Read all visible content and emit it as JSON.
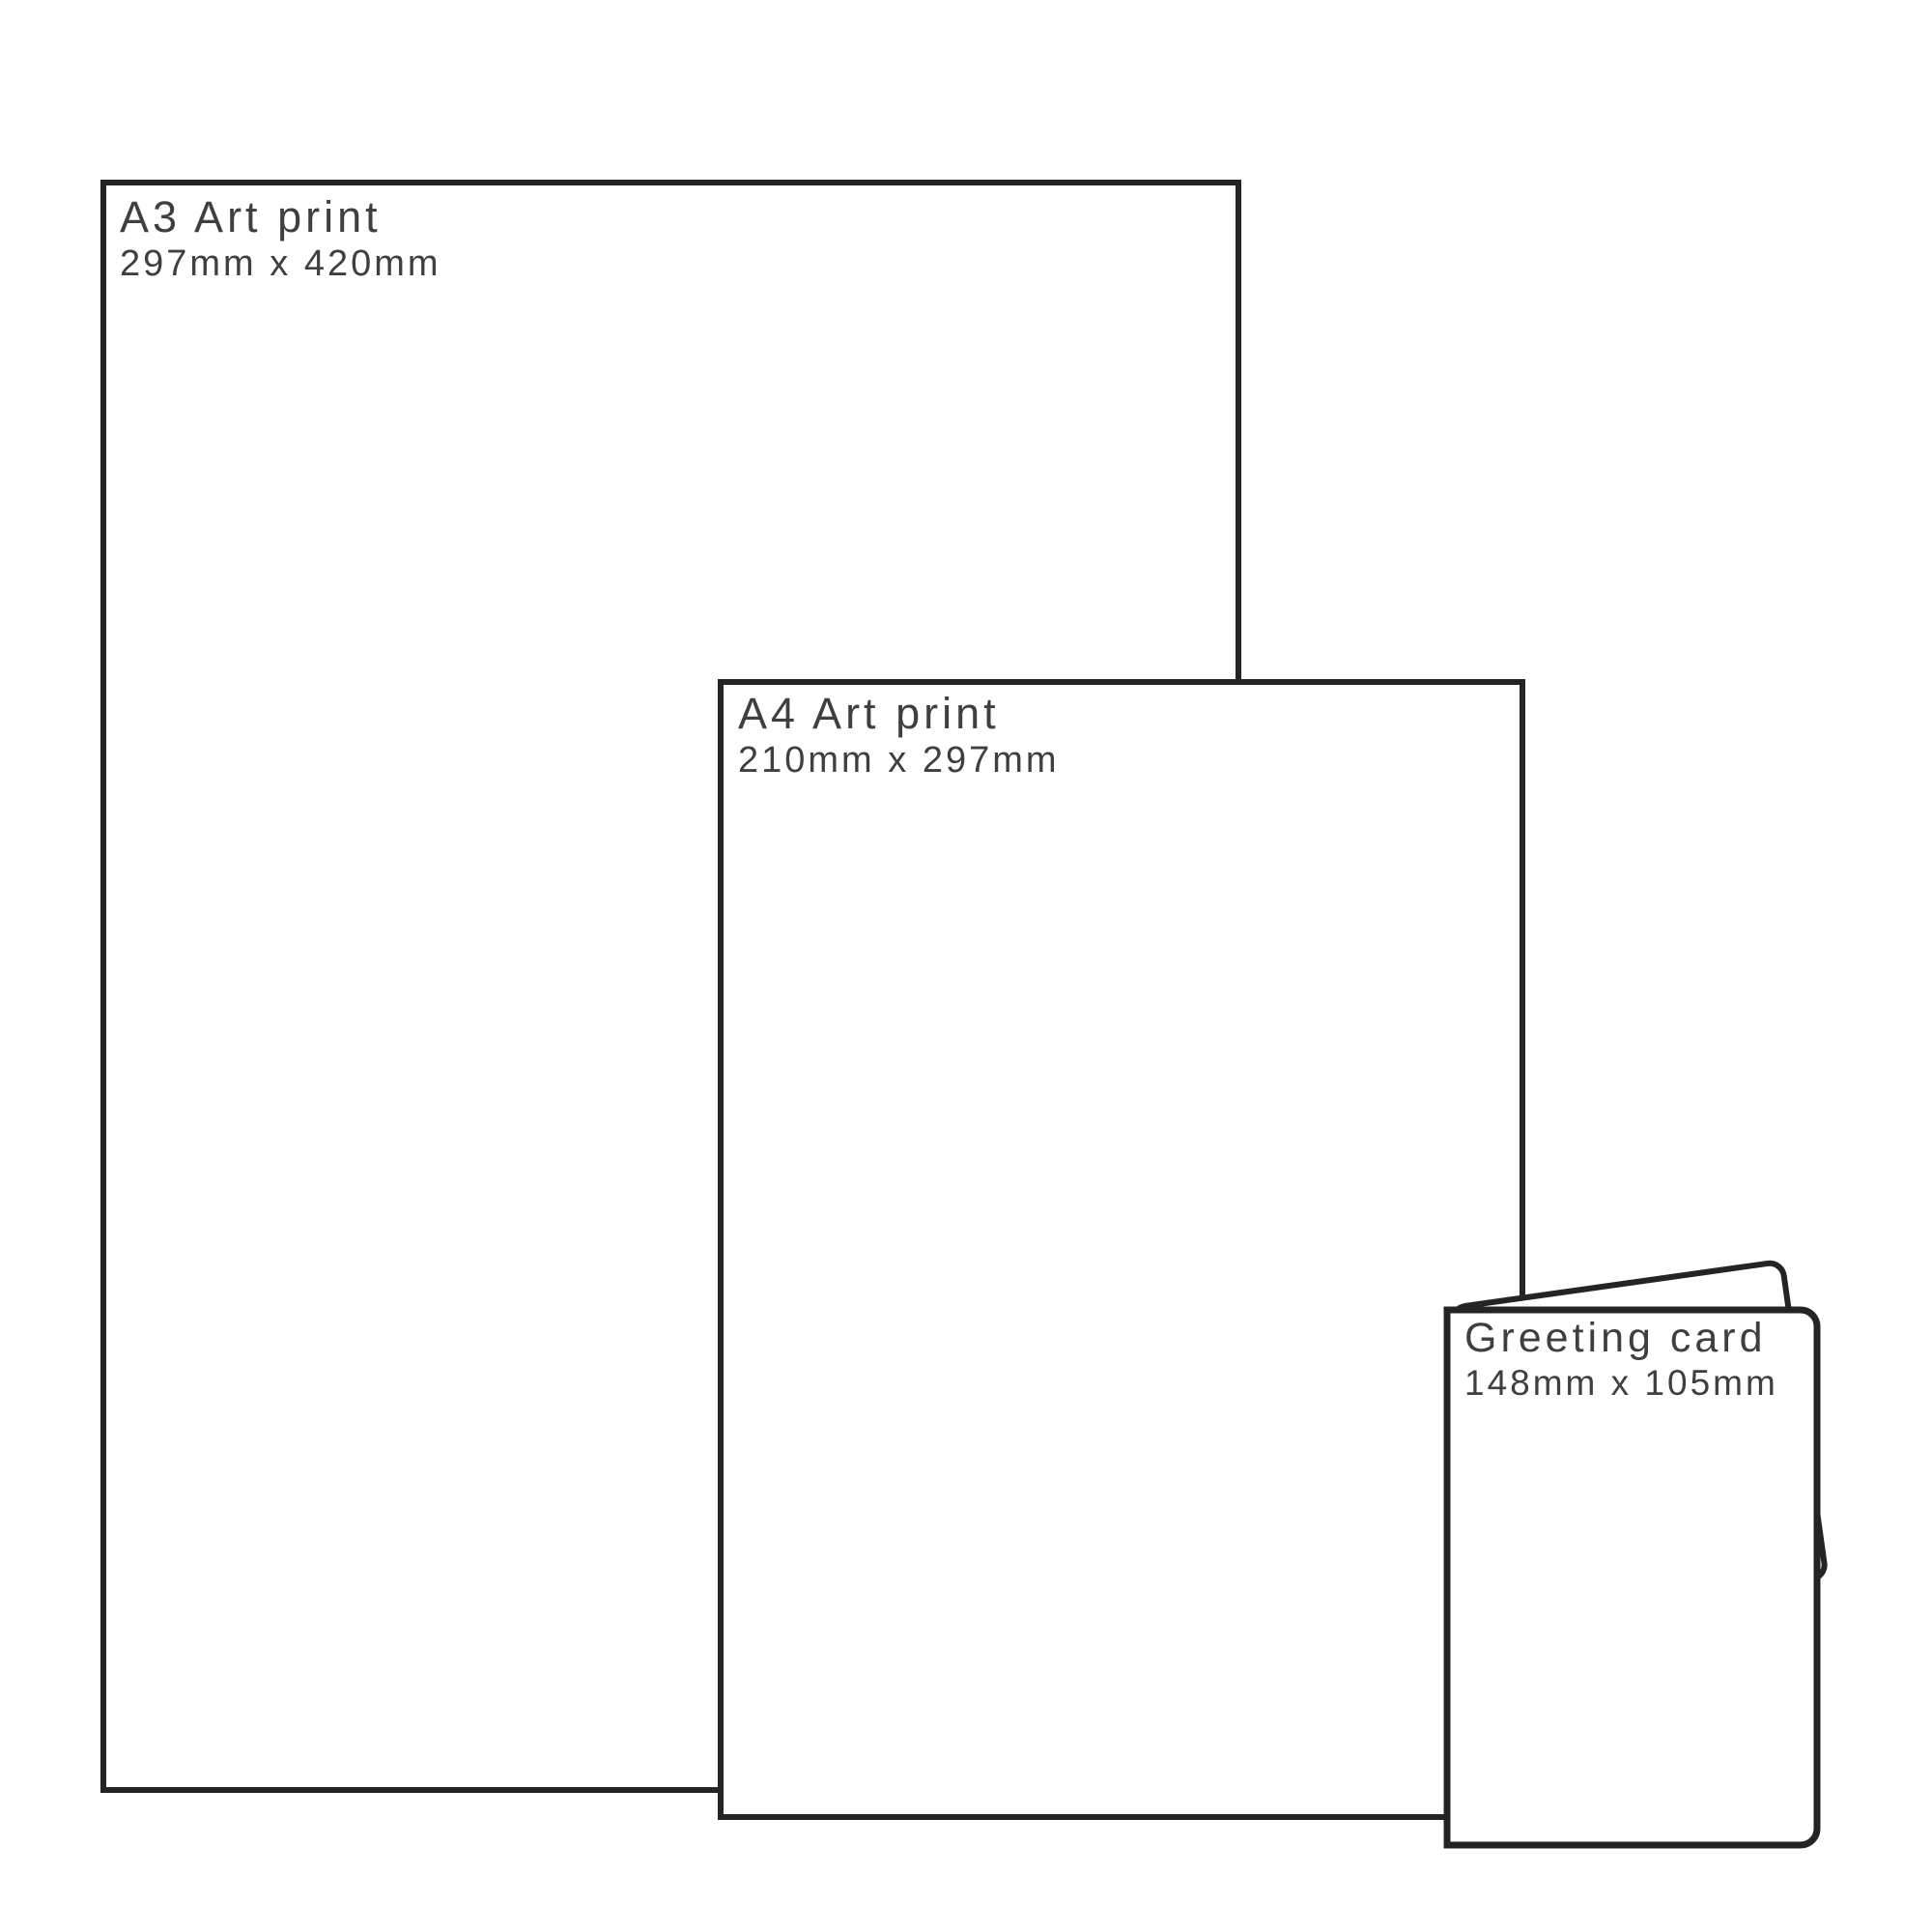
{
  "page": {
    "background": "#ffffff",
    "outline_color": "#242424",
    "text_color": "#3f3f3f",
    "description": "Print size comparison diagram"
  },
  "items": [
    {
      "name": "a3-art-print",
      "label": "A3 Art print",
      "dimensions": "297mm x 420mm"
    },
    {
      "name": "a4-art-print",
      "label": "A4 Art print",
      "dimensions": "210mm x 297mm"
    },
    {
      "name": "greeting-card",
      "label": "Greeting card",
      "dimensions": "148mm x 105mm"
    }
  ]
}
